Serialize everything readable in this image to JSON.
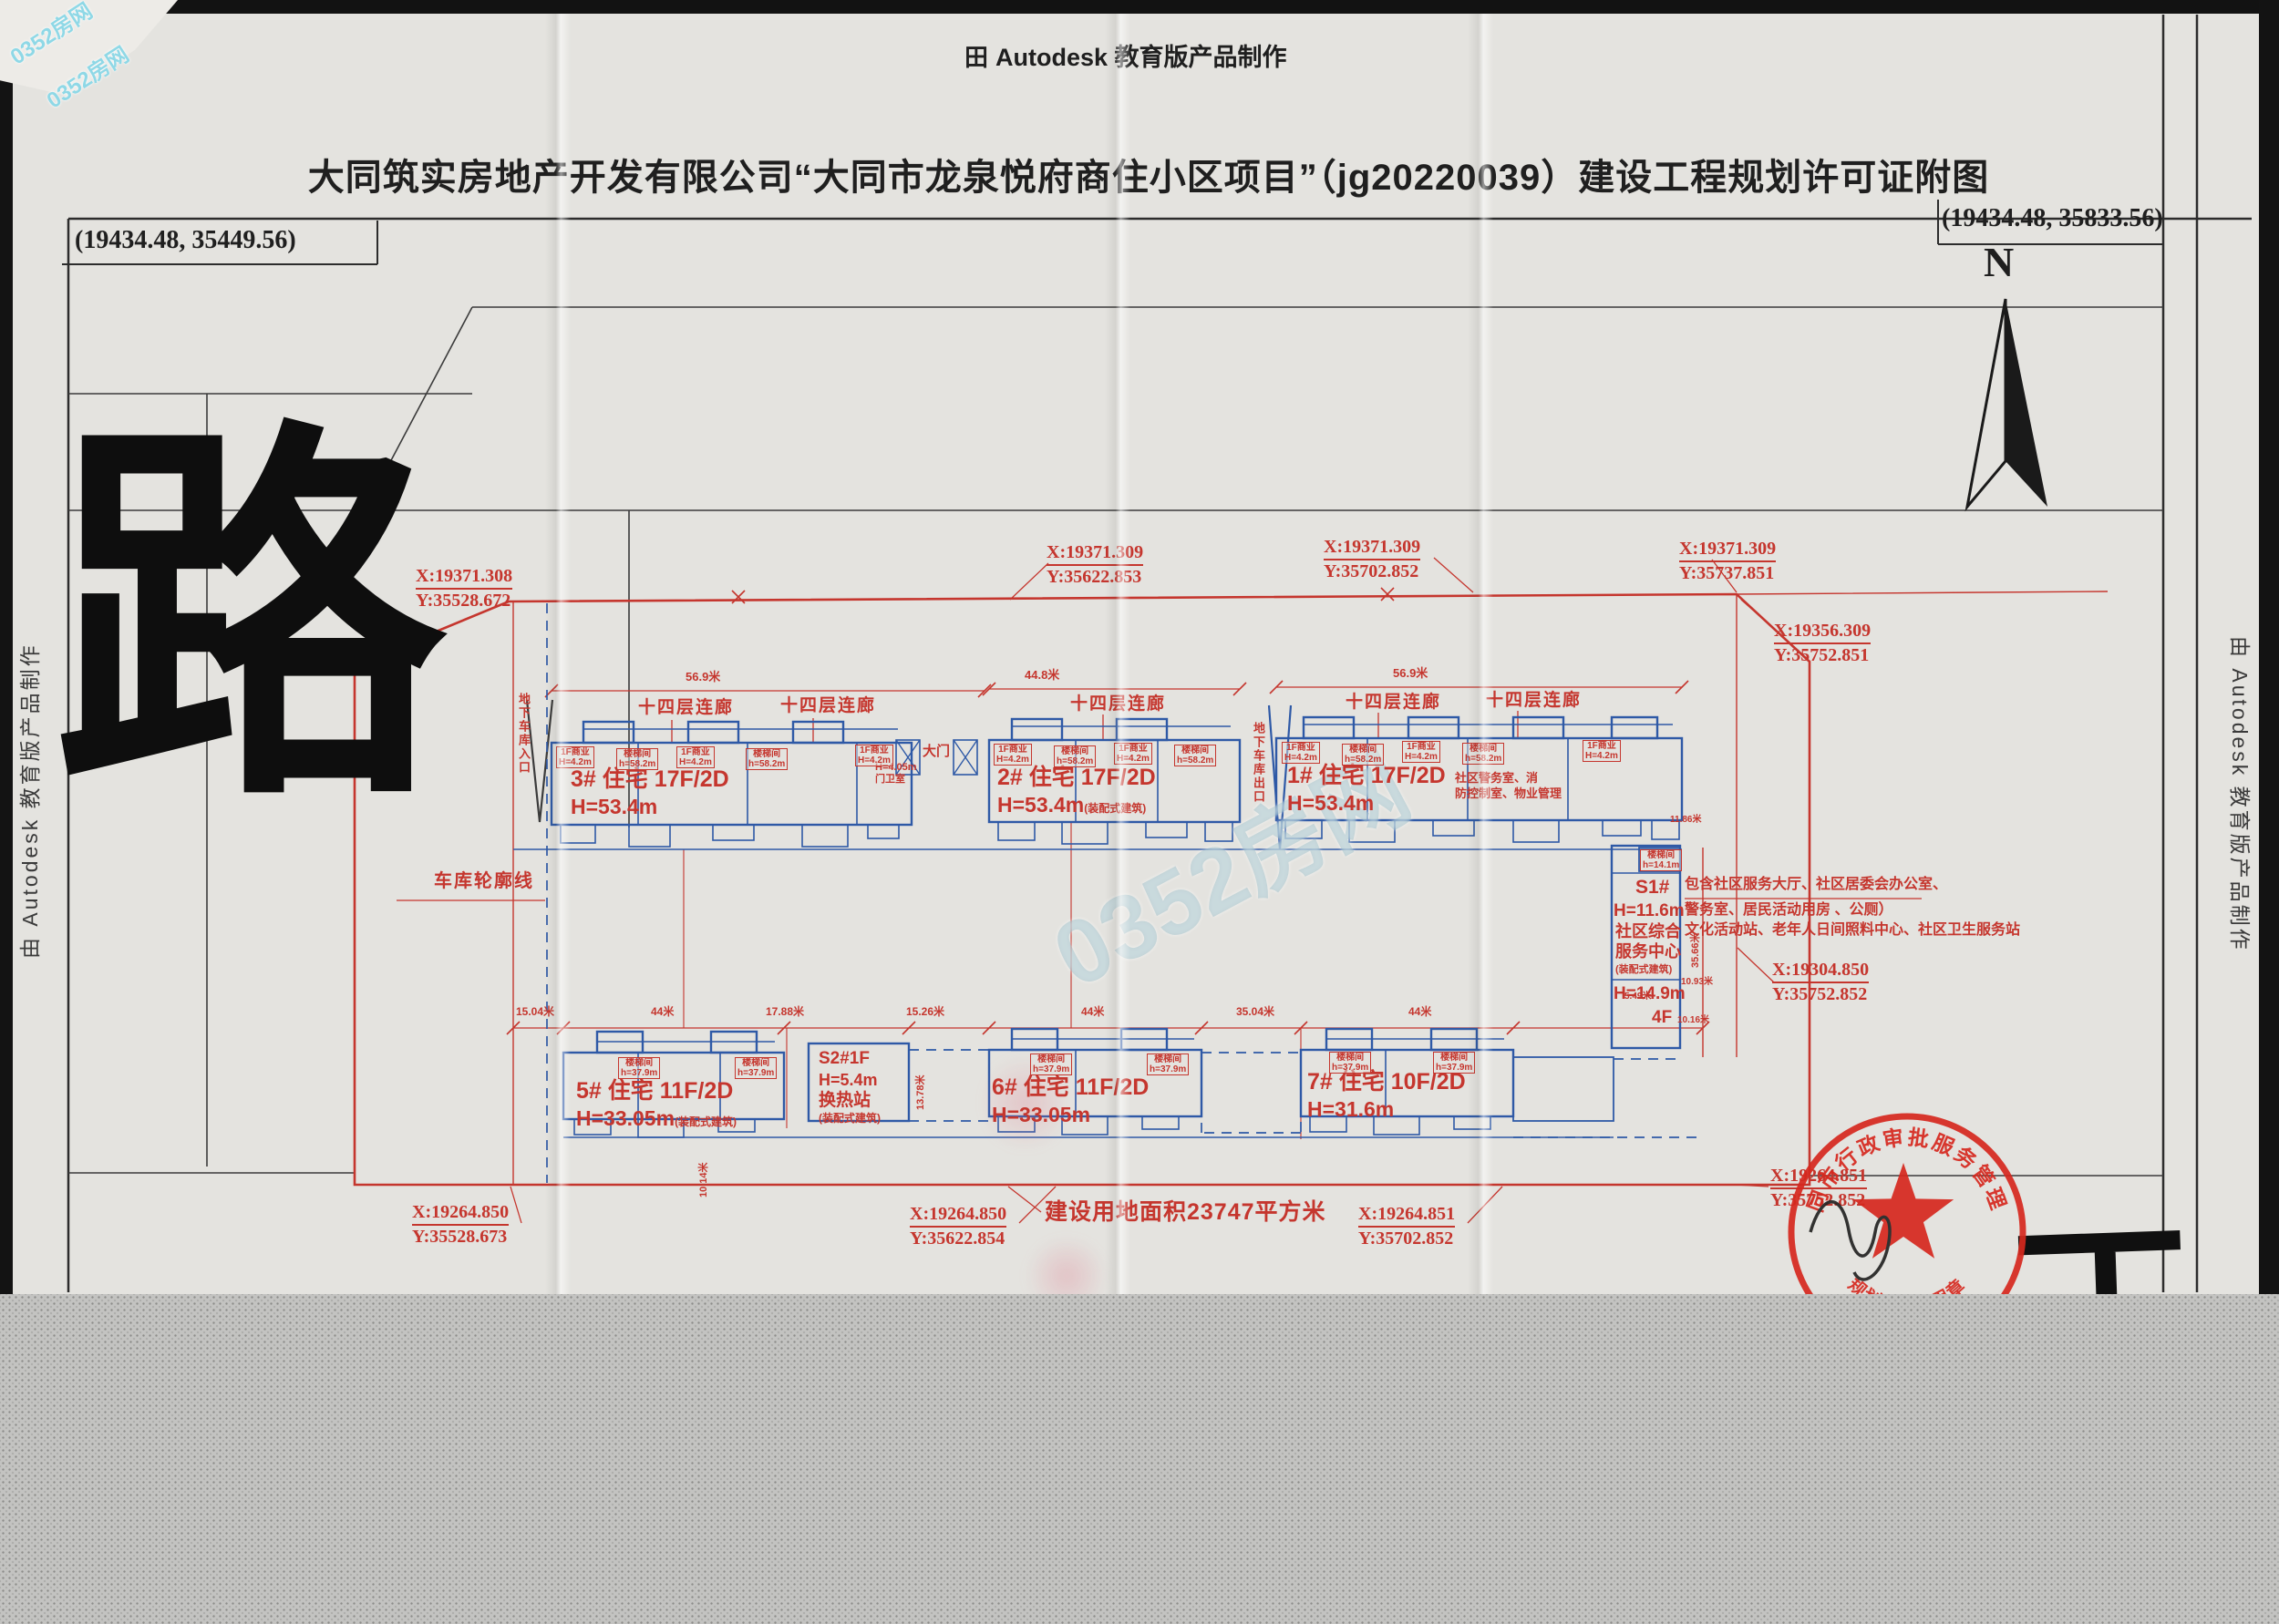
{
  "page": {
    "top_logo": "田",
    "top_watermark": "Autodesk 教育版产品制作",
    "title": "大同筑实房地产开发有限公司“大同市龙泉悦府商住小区项目”（jg20220039）建设工程规划许可证附图",
    "corner_coord_left": "(19434.48, 35449.56)",
    "corner_coord_right": "(19434.48, 35833.56)",
    "side_watermark_left": "由 Autodesk 教育版产品制作",
    "side_watermark_right": "由 Autodesk 教育版产品制作",
    "north_label": "N",
    "road_character": "路",
    "edge_character_fragment": "丁"
  },
  "brand": {
    "watermark": "0352房网"
  },
  "site": {
    "area_label": "建设用地面积23747平方米",
    "garage_outline_label": "车库轮廓线",
    "garage_entrance_label": "地下车库入口",
    "garage_exit_label": "地下车库出口",
    "gate_label": "大门",
    "guard_height": "H=4.05m",
    "guard_label": "门卫室",
    "corridor_label": "十四层连廊",
    "mgmt_line1": "社区警务室、消",
    "mgmt_line2": "防控制室、物业管理",
    "s1_note_line1": "包含社区服务大厅、社区居委会办公室、",
    "s1_note_line2": "警务室、居民活动用房 、公厕）",
    "s1_note_line3": "文化活动站、老年人日间照料中心、社区卫生服务站"
  },
  "buildings": {
    "b3": {
      "name": "3# 住宅 17F/2D",
      "height": "H=53.4m"
    },
    "b2": {
      "name": "2# 住宅 17F/2D",
      "height": "H=53.4m",
      "note": "(装配式建筑)"
    },
    "b1": {
      "name": "1# 住宅 17F/2D",
      "height": "H=53.4m"
    },
    "b5": {
      "name": "5# 住宅 11F/2D",
      "height": "H=33.05m",
      "note": "(装配式建筑)"
    },
    "b6": {
      "name": "6# 住宅 11F/2D",
      "height": "H=33.05m"
    },
    "b7": {
      "name": "7# 住宅 10F/2D",
      "height": "H=31.6m"
    },
    "s2": {
      "l1": "S2#1F",
      "l2": "H=5.4m",
      "l3": "换热站",
      "l4": "(装配式建筑)"
    },
    "s1": {
      "stair_l1": "楼梯间",
      "stair_l2": "h=14.1m",
      "name": "S1#",
      "h1": "H=11.6m",
      "use1": "社区综合",
      "use2": "服务中心",
      "note": "(装配式建筑)",
      "h2": "H=14.9m",
      "floors": "4F"
    }
  },
  "mini": {
    "shop_l1": "1F商业",
    "shop_l2": "H=4.2m",
    "stair_l1": "楼梯间",
    "stair_h58": "h=58.2m",
    "stair_h37": "h=37.9m"
  },
  "dims": {
    "top": [
      "56.9米",
      "44.8米",
      "56.9米"
    ],
    "mid": [
      "15.04米",
      "44米",
      "17.88米",
      "15.26米",
      "44米",
      "35.04米",
      "44米"
    ],
    "right": [
      "11.86米",
      "35.66米",
      "10.93米",
      "5.49米",
      "10.16米"
    ],
    "vert": [
      "13.78米",
      "10.14米"
    ]
  },
  "coords": [
    {
      "x": "X:19371.308",
      "y": "Y:35528.672"
    },
    {
      "x": "X:19371.309",
      "y": "Y:35622.853"
    },
    {
      "x": "X:19371.309",
      "y": "Y:35702.852"
    },
    {
      "x": "X:19371.309",
      "y": "Y:35737.851"
    },
    {
      "x": "X:19356.309",
      "y": "Y:35752.851"
    },
    {
      "x": "X:19304.850",
      "y": "Y:35752.852"
    },
    {
      "x": "X:19264.850",
      "y": "Y:35528.673"
    },
    {
      "x": "X:19264.850",
      "y": "Y:35622.854"
    },
    {
      "x": "X:19264.851",
      "y": "Y:35702.852"
    },
    {
      "x": "X:19264.851",
      "y": "Y:35752.852"
    }
  ],
  "stamp": {
    "arc_top": "大同市行政审批服务管理局",
    "arc_bottom": "规划许可专用章"
  },
  "colors": {
    "annotation_red": "#c5362e",
    "building_blue": "#2e59a6",
    "stamp_red": "#d6281e",
    "paper": "#e4e3df",
    "watermark_cyan": "#8fd8e6"
  }
}
